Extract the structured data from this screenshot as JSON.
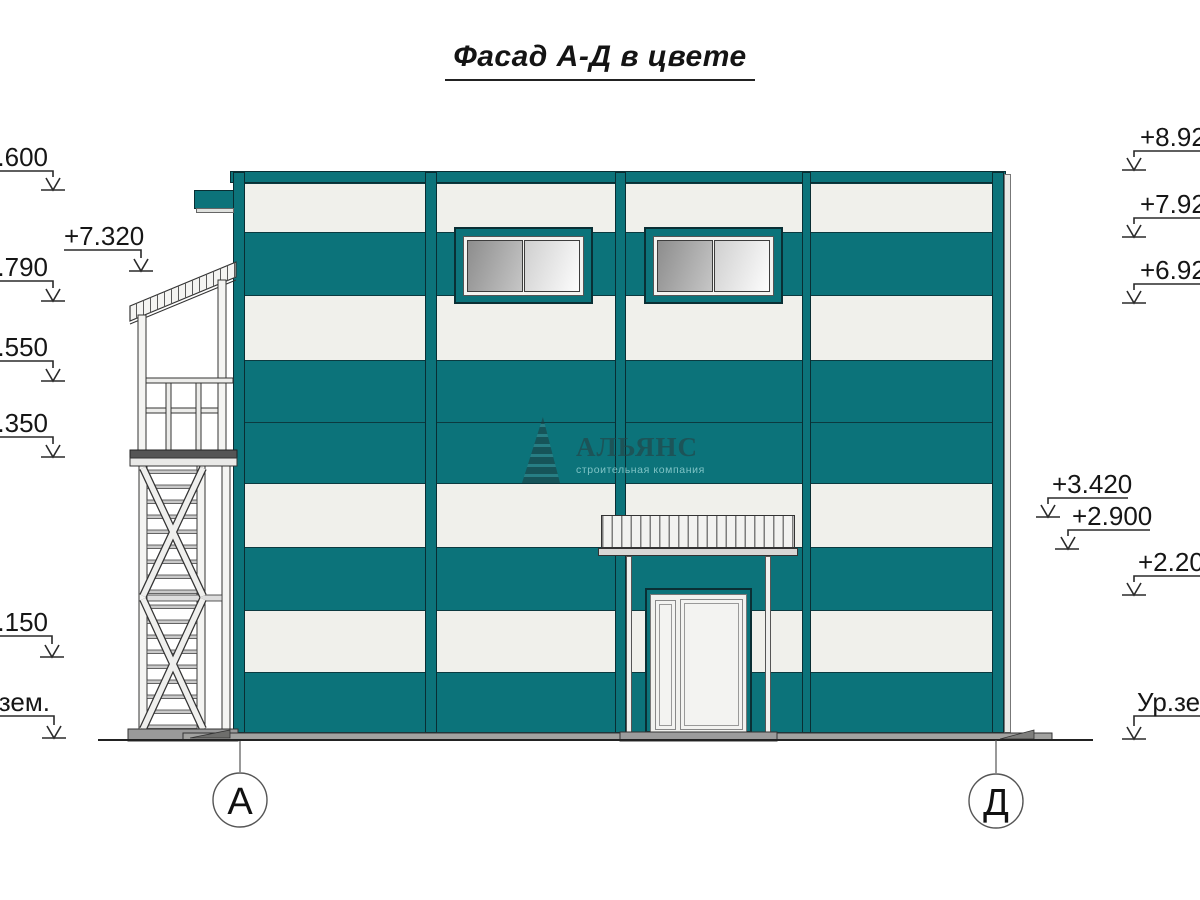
{
  "title": "Фасад А-Д в цвете",
  "watermark": {
    "company_name": "АЛЬЯНС",
    "company_subtitle": "строительная компания",
    "logo": "pyramid-logo"
  },
  "elevation_markers": {
    "left": [
      {
        "label": "+8.600"
      },
      {
        "label": "+7.320"
      },
      {
        "label": "+6.790"
      },
      {
        "label": "+5.550"
      },
      {
        "label": "+4.350"
      },
      {
        "label": "+1.150"
      },
      {
        "label": "Ур.зем."
      }
    ],
    "right": [
      {
        "label": "+8.920"
      },
      {
        "label": "+7.920"
      },
      {
        "label": "+6.920"
      },
      {
        "label": "+3.420"
      },
      {
        "label": "+2.900"
      },
      {
        "label": "+2.200"
      },
      {
        "label": "Ур.зем."
      }
    ]
  },
  "axes": [
    {
      "label": "А"
    },
    {
      "label": "Д"
    }
  ],
  "colors": {
    "facade_teal": "#0c737a",
    "stripe_white": "#f0f0eb",
    "outline_dark": "#092e33",
    "glass_gray": "#9a9a9a",
    "base_gray": "#9e9e9c"
  }
}
